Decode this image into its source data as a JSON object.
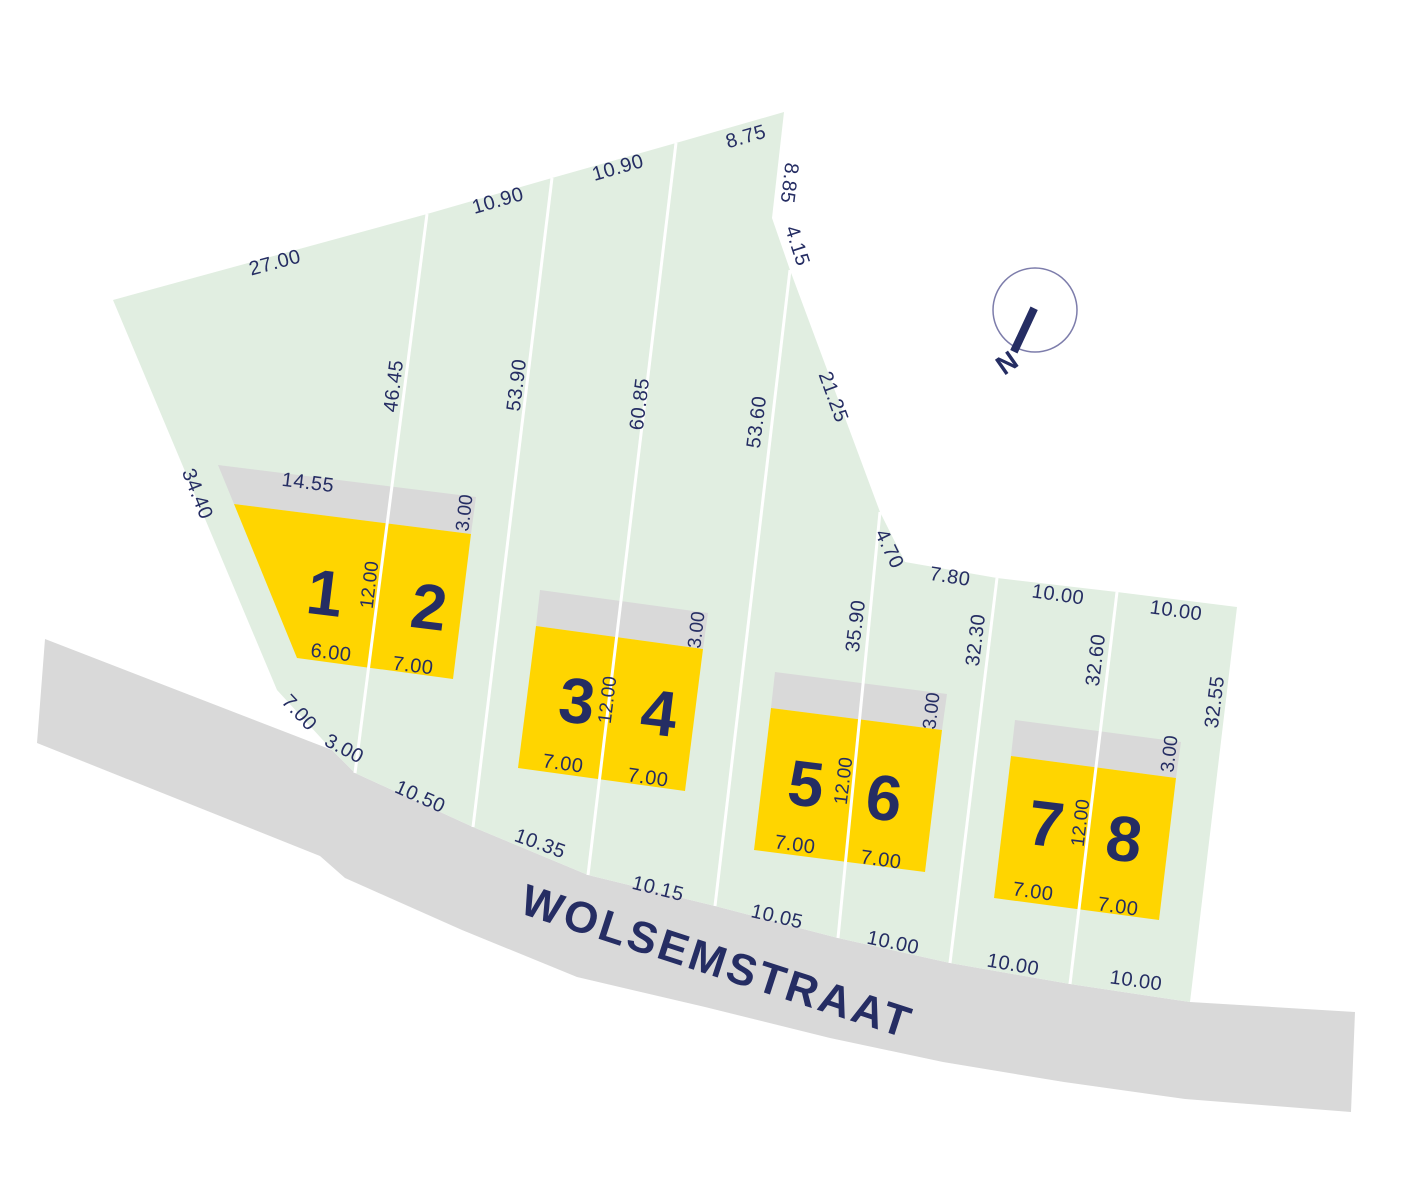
{
  "colors": {
    "parcel_green": "#e1eee1",
    "building_yellow": "#ffd500",
    "strip_gray": "#d9d9d9",
    "street_gray": "#d9d9d9",
    "ink_navy": "#252d63"
  },
  "street": {
    "name": "WOLSEMSTRAAT"
  },
  "compass": {
    "north_label": "N"
  },
  "lots": {
    "numbers": [
      "1",
      "2",
      "3",
      "4",
      "5",
      "6",
      "7",
      "8"
    ]
  },
  "dimensions": {
    "outer": {
      "left_edge": "34.40",
      "top_edges": [
        "27.00",
        "10.90",
        "10.90",
        "8.75"
      ],
      "upper_right_edges": [
        "8.85",
        "4.15",
        "21.25",
        "4.70"
      ],
      "right_top_edges": [
        "7.80",
        "10.00",
        "10.00"
      ],
      "right_edge": "32.55",
      "corner_edges": [
        "7.00",
        "3.00"
      ],
      "street_frontages": [
        "10.50",
        "10.35",
        "10.15",
        "10.05",
        "10.00",
        "10.00",
        "10.00"
      ]
    },
    "lot_lines": [
      "46.45",
      "53.90",
      "60.85",
      "53.60",
      "35.90",
      "32.30",
      "32.60"
    ],
    "building_pairs": [
      {
        "top_width": "14.55",
        "strip_depth": "3.00",
        "house_depth": "12.00",
        "house_widths": [
          "6.00",
          "7.00"
        ]
      },
      {
        "strip_depth": "3.00",
        "house_depth": "12.00",
        "house_widths": [
          "7.00",
          "7.00"
        ]
      },
      {
        "strip_depth": "3.00",
        "house_depth": "12.00",
        "house_widths": [
          "7.00",
          "7.00"
        ]
      },
      {
        "strip_depth": "3.00",
        "house_depth": "12.00",
        "house_widths": [
          "7.00",
          "7.00"
        ]
      }
    ]
  }
}
